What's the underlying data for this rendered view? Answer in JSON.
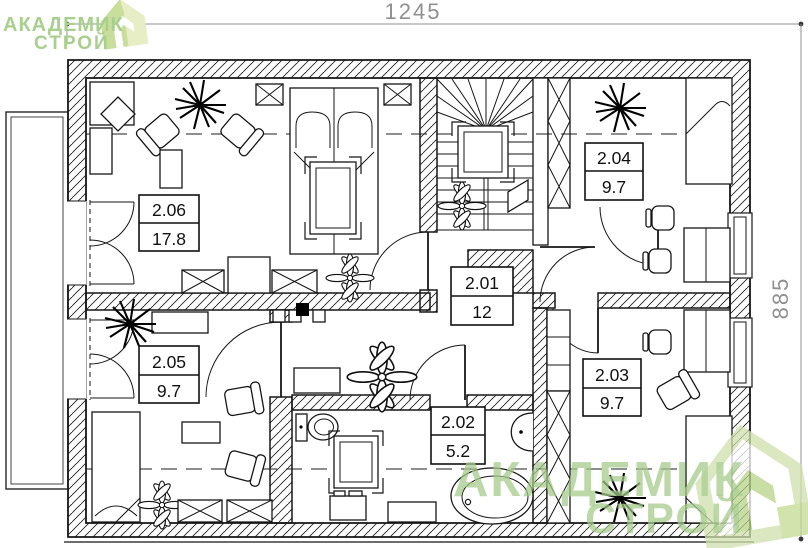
{
  "drawing": {
    "type": "floor-plan",
    "floor_hint": "attic level plan with roof break dashed lines"
  },
  "dimensions": {
    "width_label": "1245",
    "height_label": "885"
  },
  "brand": {
    "line1": "АКАДЕМИК",
    "line2": "СТРОЙ"
  },
  "rooms": [
    {
      "number": "2.01",
      "area": "12"
    },
    {
      "number": "2.02",
      "area": "5.2"
    },
    {
      "number": "2.03",
      "area": "9.7"
    },
    {
      "number": "2.04",
      "area": "9.7"
    },
    {
      "number": "2.05",
      "area": "9.7"
    },
    {
      "number": "2.06",
      "area": "17.8"
    }
  ],
  "colors": {
    "logo_green": "#a9cf8e",
    "dimension_gray": "#8f9090",
    "line_black": "#161616"
  }
}
